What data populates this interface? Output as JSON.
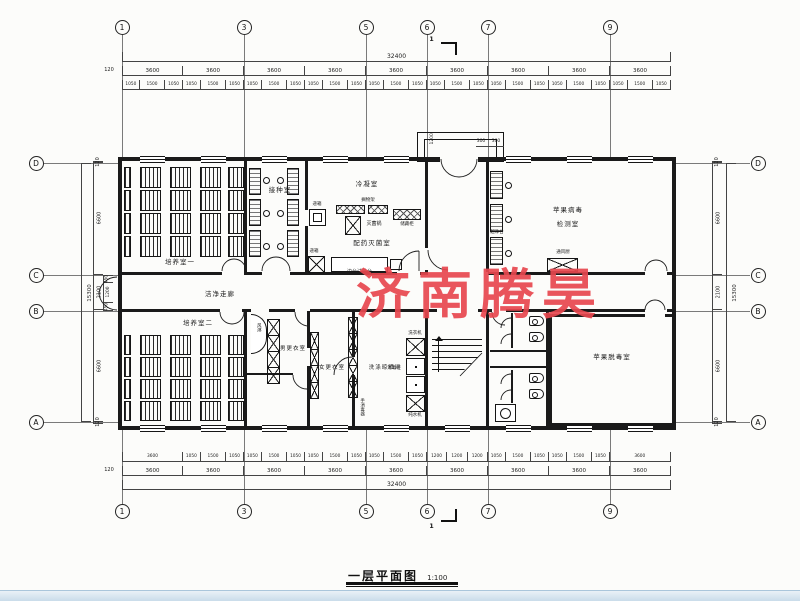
{
  "watermark": {
    "text": "济南腾昊",
    "color": "#e8474f"
  },
  "title": {
    "text": "一层平面图",
    "scale": "1:100"
  },
  "section_marker": "1",
  "axis": {
    "top": [
      {
        "n": "1",
        "x": 122
      },
      {
        "n": "3",
        "x": 244
      },
      {
        "n": "5",
        "x": 366
      },
      {
        "n": "6",
        "x": 427
      },
      {
        "n": "7",
        "x": 488
      },
      {
        "n": "9",
        "x": 610
      }
    ],
    "bottom": [
      {
        "n": "1",
        "x": 122
      },
      {
        "n": "3",
        "x": 244
      },
      {
        "n": "5",
        "x": 366
      },
      {
        "n": "6",
        "x": 427
      },
      {
        "n": "7",
        "x": 488
      },
      {
        "n": "9",
        "x": 610
      }
    ],
    "left": [
      {
        "n": "D",
        "y": 163
      },
      {
        "n": "C",
        "y": 275
      },
      {
        "n": "B",
        "y": 311
      },
      {
        "n": "A",
        "y": 422
      }
    ],
    "right": [
      {
        "n": "D",
        "y": 163
      },
      {
        "n": "C",
        "y": 275
      },
      {
        "n": "B",
        "y": 311
      },
      {
        "n": "A",
        "y": 422
      }
    ]
  },
  "dims": {
    "top_overall": "32400",
    "bottom_overall": "32400",
    "side_overall": "15300",
    "offset": "120",
    "top_bays": [
      "3600",
      "3600",
      "3600",
      "3600",
      "3600",
      "3600",
      "3600",
      "3600",
      "3600"
    ],
    "bottom_bays": [
      "3600",
      "3600",
      "3600",
      "3600",
      "3600",
      "3600",
      "3600",
      "3600",
      "3600"
    ],
    "top_detail": [
      "1050",
      "1500",
      "1050",
      "1050",
      "1500",
      "1050",
      "1050",
      "1500",
      "1050",
      "1050",
      "1500",
      "1050",
      "1050",
      "1500",
      "1050",
      "1050",
      "1500",
      "1050",
      "1050",
      "1500",
      "1050",
      "1050",
      "1500",
      "1050",
      "1050",
      "1500",
      "1050"
    ],
    "bottom_detail": [
      "3600",
      "1050",
      "1500",
      "1050",
      "1050",
      "1500",
      "1050",
      "1050",
      "1500",
      "1050",
      "1050",
      "1500",
      "1050",
      "1200",
      "1200",
      "1200",
      "1050",
      "1500",
      "1050",
      "1050",
      "1500",
      "1050",
      "3600"
    ],
    "side_segments": [
      "120",
      "6600",
      "2100",
      "6600",
      "120"
    ],
    "left_inner": [
      "450",
      "1200",
      "450"
    ],
    "porch": {
      "width_left": "1200",
      "seg_a": "300",
      "seg_b": "300"
    }
  },
  "rooms": {
    "culture1": "培养室一",
    "culture2": "培养室二",
    "inoculation": "接种室",
    "condensation": "冷凝室",
    "prep_steril": "配药灭菌室",
    "virus_test_line1": "苹果病毒",
    "virus_test_line2": "检测室",
    "corridor": "洁净走廊",
    "men_change": "男更衣室",
    "women_change": "女更衣室",
    "wash_dry": "洗涤晾晒间",
    "detox": "苹果脱毒室"
  },
  "equipment": {
    "pass_box": "递箱",
    "shelf": "搁物架",
    "sterilizer": "灭菌锅",
    "storage": "储藏柜",
    "side_bench": "边台试验台",
    "clean_bench": "超净台",
    "fume_hood": "通风厨",
    "air_shower": "风淋",
    "washer": "洗衣机",
    "disinfect": "消毒柜",
    "pure_water": "纯水机",
    "hand_sanitizer": "手消毒器"
  }
}
